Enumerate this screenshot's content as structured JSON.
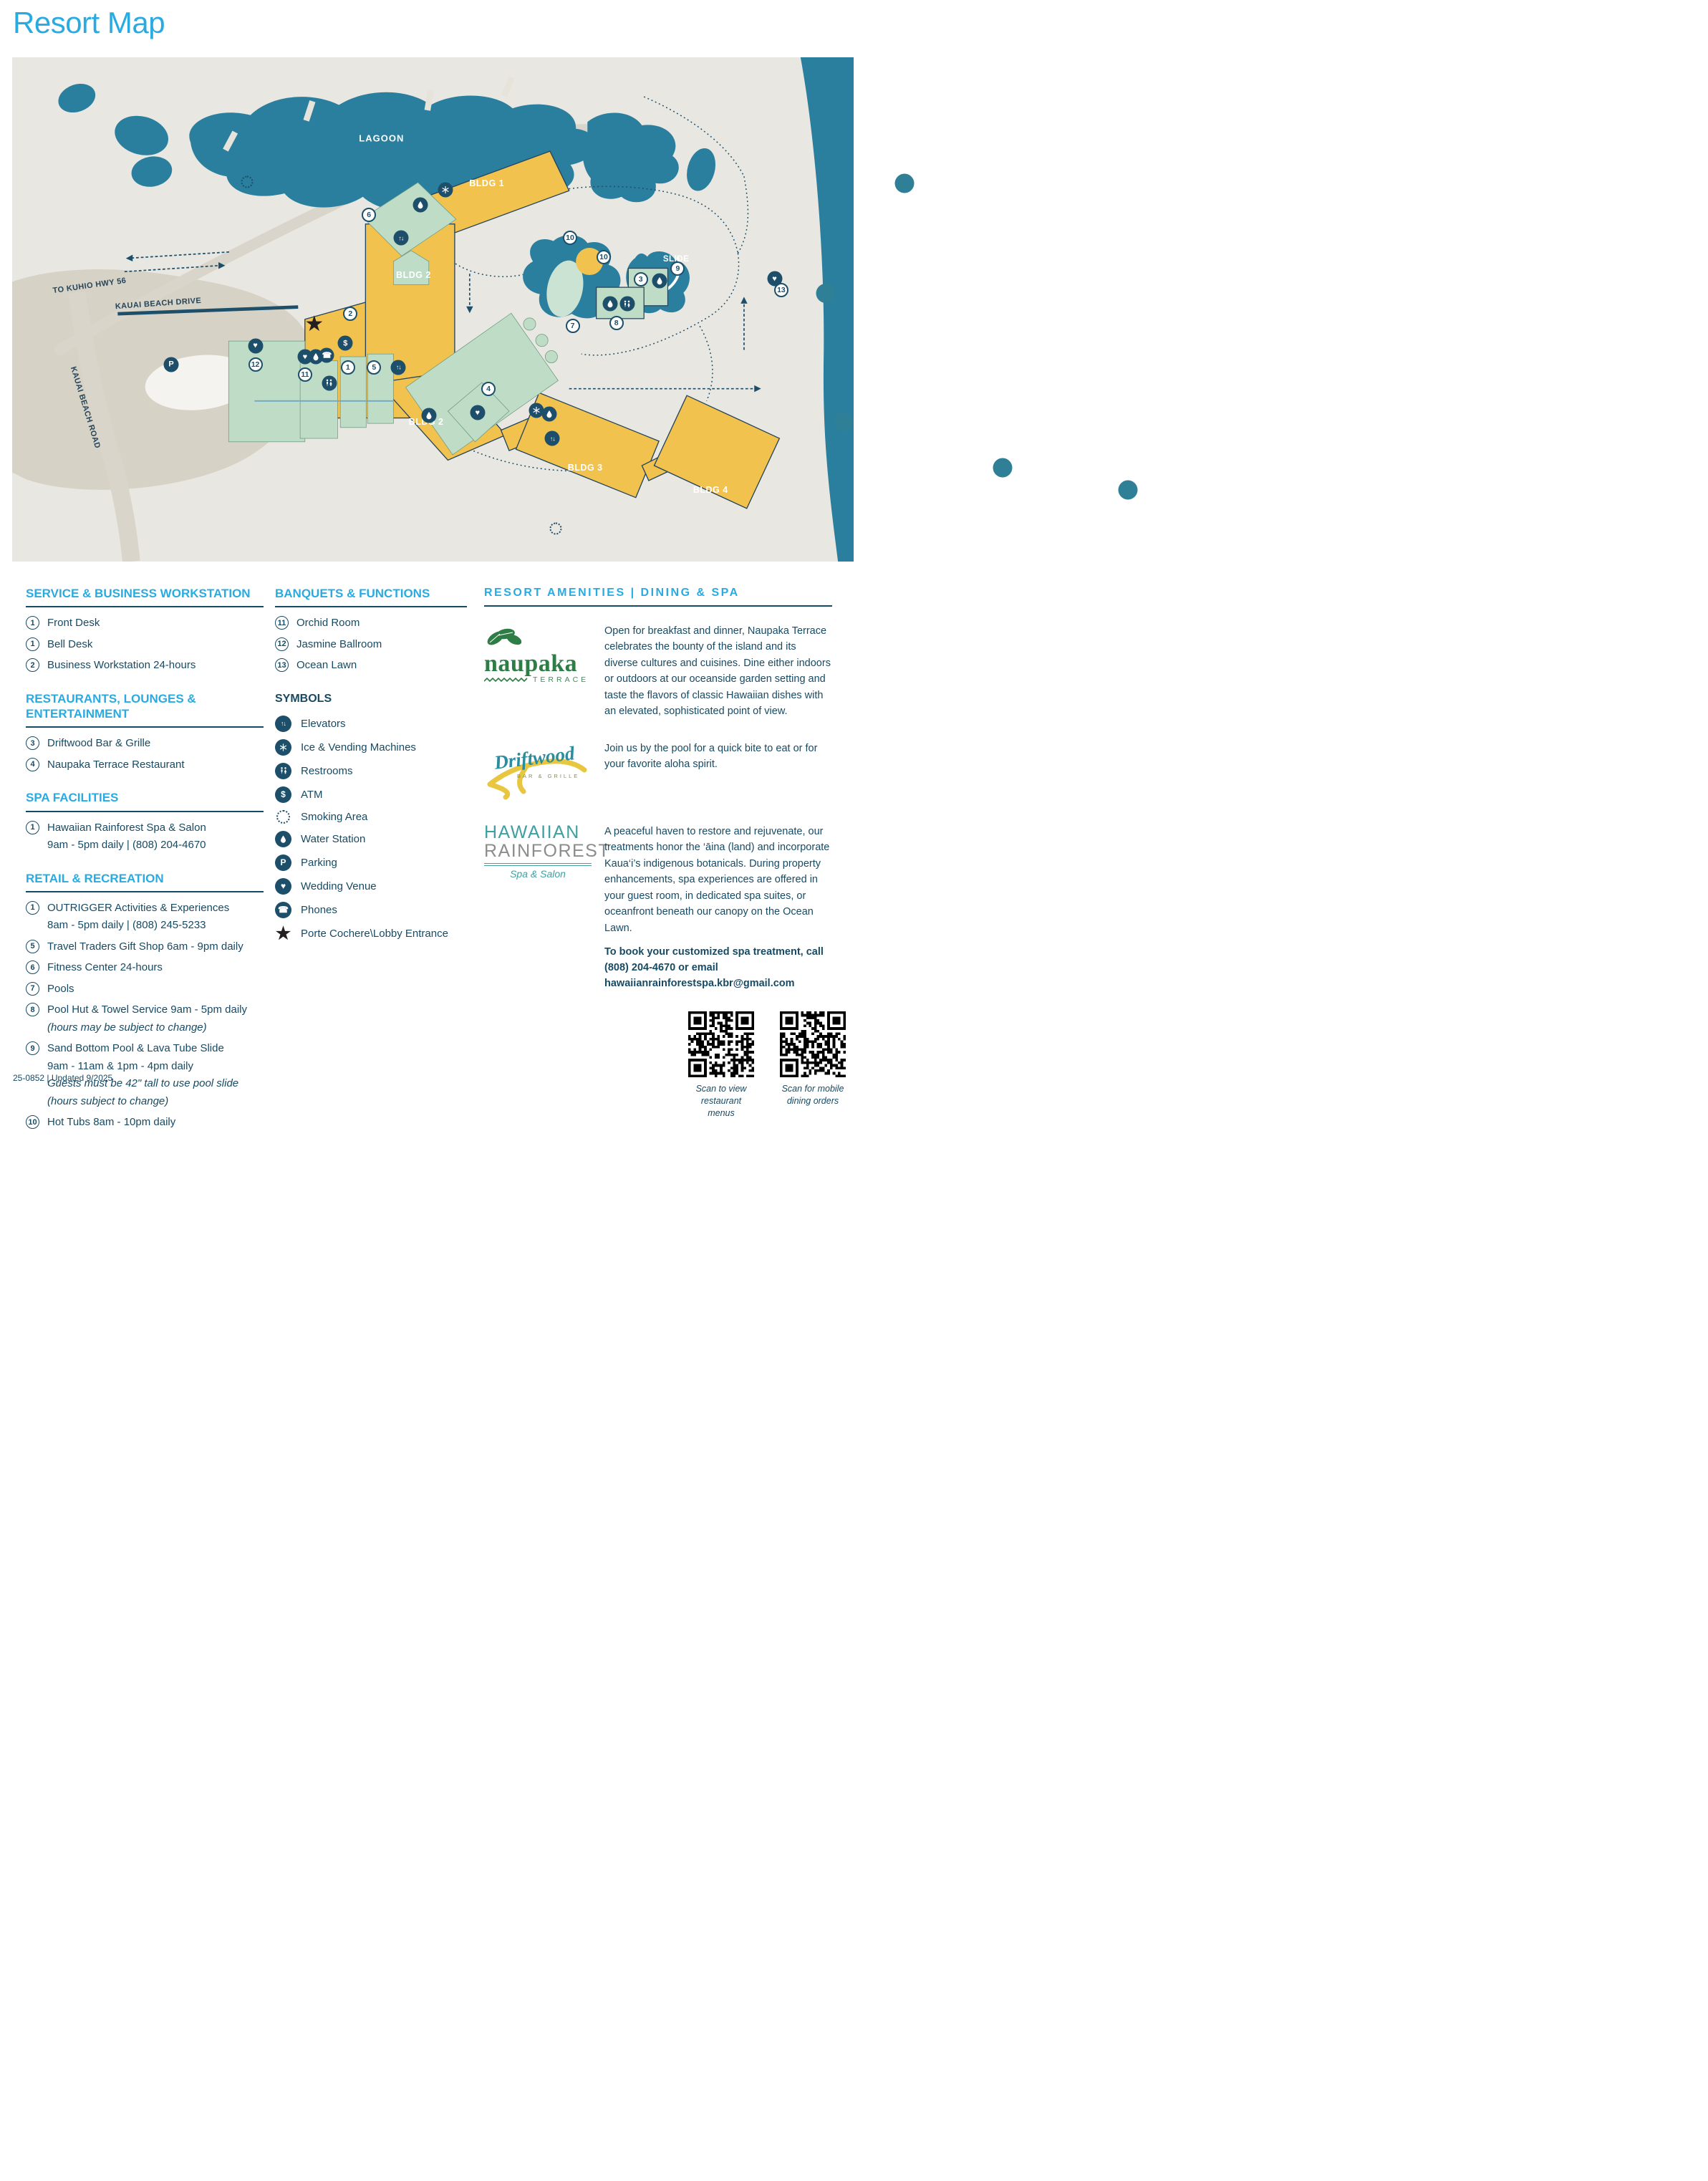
{
  "page": {
    "title": "Resort Map",
    "footer": "25-0852 | Updated 9/2025",
    "accent": "#29ABE2",
    "navy": "#174A63",
    "water": "#2A7E9E",
    "building_yellow": "#F2C24F",
    "building_green": "#BEDCC6"
  },
  "map": {
    "markers": [
      {
        "t": "label",
        "name": "lagoon-label",
        "label": "LAGOON",
        "cls": "lbl-water",
        "x": 43.9,
        "y": 16.1
      },
      {
        "t": "label",
        "name": "slide-label",
        "label": "SLIDE",
        "cls": "lbl-water-sm",
        "x": 78.9,
        "y": 40.1
      },
      {
        "t": "label",
        "name": "to-kuhio-hwy-label",
        "label": "TO KUHIO HWY 56",
        "cls": "lbl-road",
        "x": 9.2,
        "y": 45.3,
        "rot": -8
      },
      {
        "t": "label",
        "name": "kauai-beach-drive-label",
        "label": "KAUAI BEACH DRIVE",
        "cls": "lbl-road",
        "x": 17.4,
        "y": 48.9,
        "rot": -4
      },
      {
        "t": "label",
        "name": "kauai-beach-road-label",
        "label": "KAUAI BEACH ROAD",
        "cls": "lbl-road",
        "x": 8.7,
        "y": 69.5,
        "rot": 73
      },
      {
        "t": "bldg",
        "name": "bldg-1-label",
        "label": "BLDG 1",
        "x": 56.4,
        "y": 25.0
      },
      {
        "t": "bldg",
        "name": "bldg-2-label",
        "label": "BLDG 2",
        "x": 47.7,
        "y": 41.2,
        "dp": "below"
      },
      {
        "t": "bldg",
        "name": "bldg-2-label",
        "label": "BLDG 2",
        "x": 49.2,
        "y": 68.3
      },
      {
        "t": "bldg",
        "name": "bldg-3-label",
        "label": "BLDG 3",
        "x": 68.1,
        "y": 75.4
      },
      {
        "t": "bldg",
        "name": "bldg-4-label",
        "label": "BLDG 4",
        "x": 83.0,
        "y": 77.9
      },
      {
        "t": "num",
        "label": "6",
        "x": 42.4,
        "y": 31.2
      },
      {
        "t": "num",
        "label": "2",
        "x": 40.2,
        "y": 50.9
      },
      {
        "t": "num",
        "label": "12",
        "x": 28.9,
        "y": 60.9
      },
      {
        "t": "num",
        "label": "11",
        "x": 34.8,
        "y": 62.9
      },
      {
        "t": "num",
        "label": "1",
        "x": 39.9,
        "y": 61.5
      },
      {
        "t": "num",
        "label": "5",
        "x": 43.0,
        "y": 61.5
      },
      {
        "t": "num",
        "label": "4",
        "x": 56.6,
        "y": 65.7
      },
      {
        "t": "num",
        "label": "10",
        "x": 66.3,
        "y": 35.8
      },
      {
        "t": "num",
        "label": "10",
        "x": 70.3,
        "y": 39.7
      },
      {
        "t": "num",
        "label": "3",
        "x": 74.7,
        "y": 44.1
      },
      {
        "t": "num",
        "label": "9",
        "x": 79.1,
        "y": 41.9
      },
      {
        "t": "num",
        "label": "7",
        "x": 66.6,
        "y": 53.2
      },
      {
        "t": "num",
        "label": "8",
        "x": 71.8,
        "y": 52.7
      },
      {
        "t": "num",
        "label": "13",
        "x": 91.4,
        "y": 46.2
      },
      {
        "t": "icon",
        "icon": "ice-vending-icon",
        "x": 51.5,
        "y": 26.3
      },
      {
        "t": "icon",
        "icon": "water-icon",
        "x": 48.5,
        "y": 29.2
      },
      {
        "t": "icon",
        "icon": "elevator-icon",
        "x": 46.2,
        "y": 35.8
      },
      {
        "t": "star",
        "icon": "porte-cochere-icon",
        "x": 35.9,
        "y": 53.0
      },
      {
        "t": "icon",
        "icon": "atm-icon",
        "x": 39.6,
        "y": 56.7
      },
      {
        "t": "icon",
        "icon": "wedding-icon",
        "x": 28.9,
        "y": 57.2
      },
      {
        "t": "icon",
        "icon": "wedding-icon",
        "x": 34.8,
        "y": 59.4
      },
      {
        "t": "icon",
        "icon": "water-icon",
        "x": 36.1,
        "y": 59.4
      },
      {
        "t": "icon",
        "icon": "phones-icon",
        "x": 37.4,
        "y": 59.1
      },
      {
        "t": "icon",
        "icon": "restrooms-icon",
        "x": 37.7,
        "y": 64.6
      },
      {
        "t": "icon",
        "icon": "elevator-icon",
        "x": 45.9,
        "y": 61.5
      },
      {
        "t": "icon",
        "icon": "water-icon",
        "x": 49.5,
        "y": 71.0
      },
      {
        "t": "icon",
        "icon": "wedding-icon",
        "x": 55.3,
        "y": 70.5
      },
      {
        "t": "icon",
        "icon": "ice-vending-icon",
        "x": 62.3,
        "y": 70.0
      },
      {
        "t": "icon",
        "icon": "water-icon",
        "x": 63.8,
        "y": 70.8
      },
      {
        "t": "icon",
        "icon": "elevator-icon",
        "x": 64.2,
        "y": 75.6
      },
      {
        "t": "icon",
        "icon": "water-icon",
        "x": 71.1,
        "y": 48.9
      },
      {
        "t": "icon",
        "icon": "restrooms-icon",
        "x": 73.1,
        "y": 48.9
      },
      {
        "t": "icon",
        "icon": "water-icon",
        "x": 76.9,
        "y": 44.3
      },
      {
        "t": "icon",
        "icon": "wedding-icon",
        "x": 90.6,
        "y": 43.9
      },
      {
        "t": "icon",
        "icon": "parking-icon",
        "x": 18.9,
        "y": 60.9
      },
      {
        "t": "smoke",
        "name": "smoking-area-icon",
        "x": 27.9,
        "y": 24.7
      },
      {
        "t": "smoke",
        "name": "smoking-area-icon",
        "x": 64.6,
        "y": 93.4
      }
    ]
  },
  "sections": {
    "services": {
      "title": "SERVICE & BUSINESS WORKSTATION",
      "items": [
        {
          "num": "1",
          "text": "Front Desk"
        },
        {
          "num": "1",
          "text": "Bell Desk"
        },
        {
          "num": "2",
          "text": "Business Workstation 24-hours"
        }
      ]
    },
    "restaurants": {
      "title_line1": "RESTAURANTS, LOUNGES &",
      "title_line2": "ENTERTAINMENT",
      "items": [
        {
          "num": "3",
          "text": "Driftwood Bar & Grille"
        },
        {
          "num": "4",
          "text": "Naupaka Terrace Restaurant"
        }
      ]
    },
    "spa": {
      "title": "SPA FACILITIES",
      "items": [
        {
          "num": "1",
          "text": "Hawaiian Rainforest Spa & Salon",
          "subs": [
            {
              "text": "9am - 5pm daily | (808) 204-4670"
            }
          ]
        }
      ]
    },
    "retail": {
      "title": "RETAIL & RECREATION",
      "items": [
        {
          "num": "1",
          "text": "OUTRIGGER Activities & Experiences",
          "subs": [
            {
              "text": "8am - 5pm daily | (808) 245-5233"
            }
          ]
        },
        {
          "num": "5",
          "text": "Travel Traders Gift Shop  6am - 9pm daily"
        },
        {
          "num": "6",
          "text": "Fitness Center 24-hours"
        },
        {
          "num": "7",
          "text": "Pools"
        },
        {
          "num": "8",
          "text": "Pool Hut & Towel Service  9am - 5pm daily",
          "subs": [
            {
              "text": "(hours may be subject to change)",
              "italic": true
            }
          ]
        },
        {
          "num": "9",
          "text": "Sand Bottom Pool & Lava Tube Slide",
          "subs": [
            {
              "text": "9am - 11am & 1pm - 4pm daily"
            },
            {
              "text": "Guests must be 42\" tall to use pool slide",
              "italic": true
            },
            {
              "text": "(hours subject to change)",
              "italic": true
            }
          ]
        },
        {
          "num": "10",
          "text": "Hot Tubs 8am - 10pm daily"
        }
      ]
    },
    "banquets": {
      "title": "BANQUETS & FUNCTIONS",
      "items": [
        {
          "num": "11",
          "text": "Orchid Room"
        },
        {
          "num": "12",
          "text": "Jasmine Ballroom"
        },
        {
          "num": "13",
          "text": "Ocean Lawn"
        }
      ]
    },
    "symbols": {
      "title": "SYMBOLS",
      "items": [
        {
          "icon": "elevator-icon",
          "text": "Elevators"
        },
        {
          "icon": "ice-vending-icon",
          "text": "Ice & Vending Machines"
        },
        {
          "icon": "restrooms-icon",
          "text": "Restrooms"
        },
        {
          "icon": "atm-icon",
          "text": "ATM"
        },
        {
          "icon": "smoking-icon",
          "text": "Smoking Area"
        },
        {
          "icon": "water-icon",
          "text": "Water Station"
        },
        {
          "icon": "parking-icon",
          "text": "Parking"
        },
        {
          "icon": "wedding-icon",
          "text": "Wedding Venue"
        },
        {
          "icon": "phones-icon",
          "text": "Phones"
        },
        {
          "icon": "porte-icon",
          "text": "Porte Cochere\\Lobby Entrance"
        }
      ]
    },
    "amenities": {
      "title": "RESORT AMENITIES | DINING & SPA",
      "naupaka": {
        "logo_name": "naupaka",
        "logo_sub": "TERRACE",
        "lines": [
          {
            "text": "Breakfast A La Carte: 7:00am - 10:30am daily"
          },
          {
            "text": "Breakfast Buffet: 7:00am - 11:00am daily"
          },
          {
            "text": "$35 adult & $18 keiki (ages 5 - 12)"
          },
          {
            "text": "Dinner: 5:00pm - 10:00pm daily"
          },
          {
            "text": "Sunset Pau Hana Hour: 5:00pm - 6:00pm daily"
          }
        ],
        "body": "Open for breakfast and dinner, Naupaka Terrace celebrates the bounty of the island and its diverse cultures and cuisines. Dine either indoors or outdoors at our oceanside garden setting and taste the flavors of classic Hawaiian dishes with an elevated, sophisticated point of view."
      },
      "driftwood": {
        "logo_name": "Driftwood",
        "logo_sub": "BAR & GRILLE",
        "lines": [
          {
            "text": "Lunch: 11:00am - 4:30pm daily"
          },
          {
            "text": "Bar: 10:00am - 6:00pm daily"
          },
          {
            "text": "Happy Hour: 3:00pm - 4:00pm daily"
          }
        ],
        "body": "Join us by the pool for a quick bite to eat or for your favorite aloha spirit."
      },
      "rainforest": {
        "logo_line1": "HAWAIIAN",
        "logo_line2": "RAINFOREST",
        "logo_sub": "Spa & Salon",
        "lines": [
          {
            "text": "Open Daily: 9:00am - 5:00pm"
          }
        ],
        "body": "A peaceful haven to restore and rejuvenate, our treatments honor the ‘āina (land) and incorporate Kaua‘i’s indigenous botanicals. During property enhancements, spa experiences are offered in your guest room, in dedicated spa suites, or oceanfront beneath our canopy on the Ocean Lawn.",
        "book": "To book your customized spa treatment, call (808) 204-4670 or email hawaiianrainforestspa.kbr@gmail.com"
      }
    },
    "qr": [
      {
        "cap1": "Scan to view",
        "cap2": "restaurant menus"
      },
      {
        "cap1": "Scan for mobile",
        "cap2": "dining orders"
      }
    ]
  }
}
